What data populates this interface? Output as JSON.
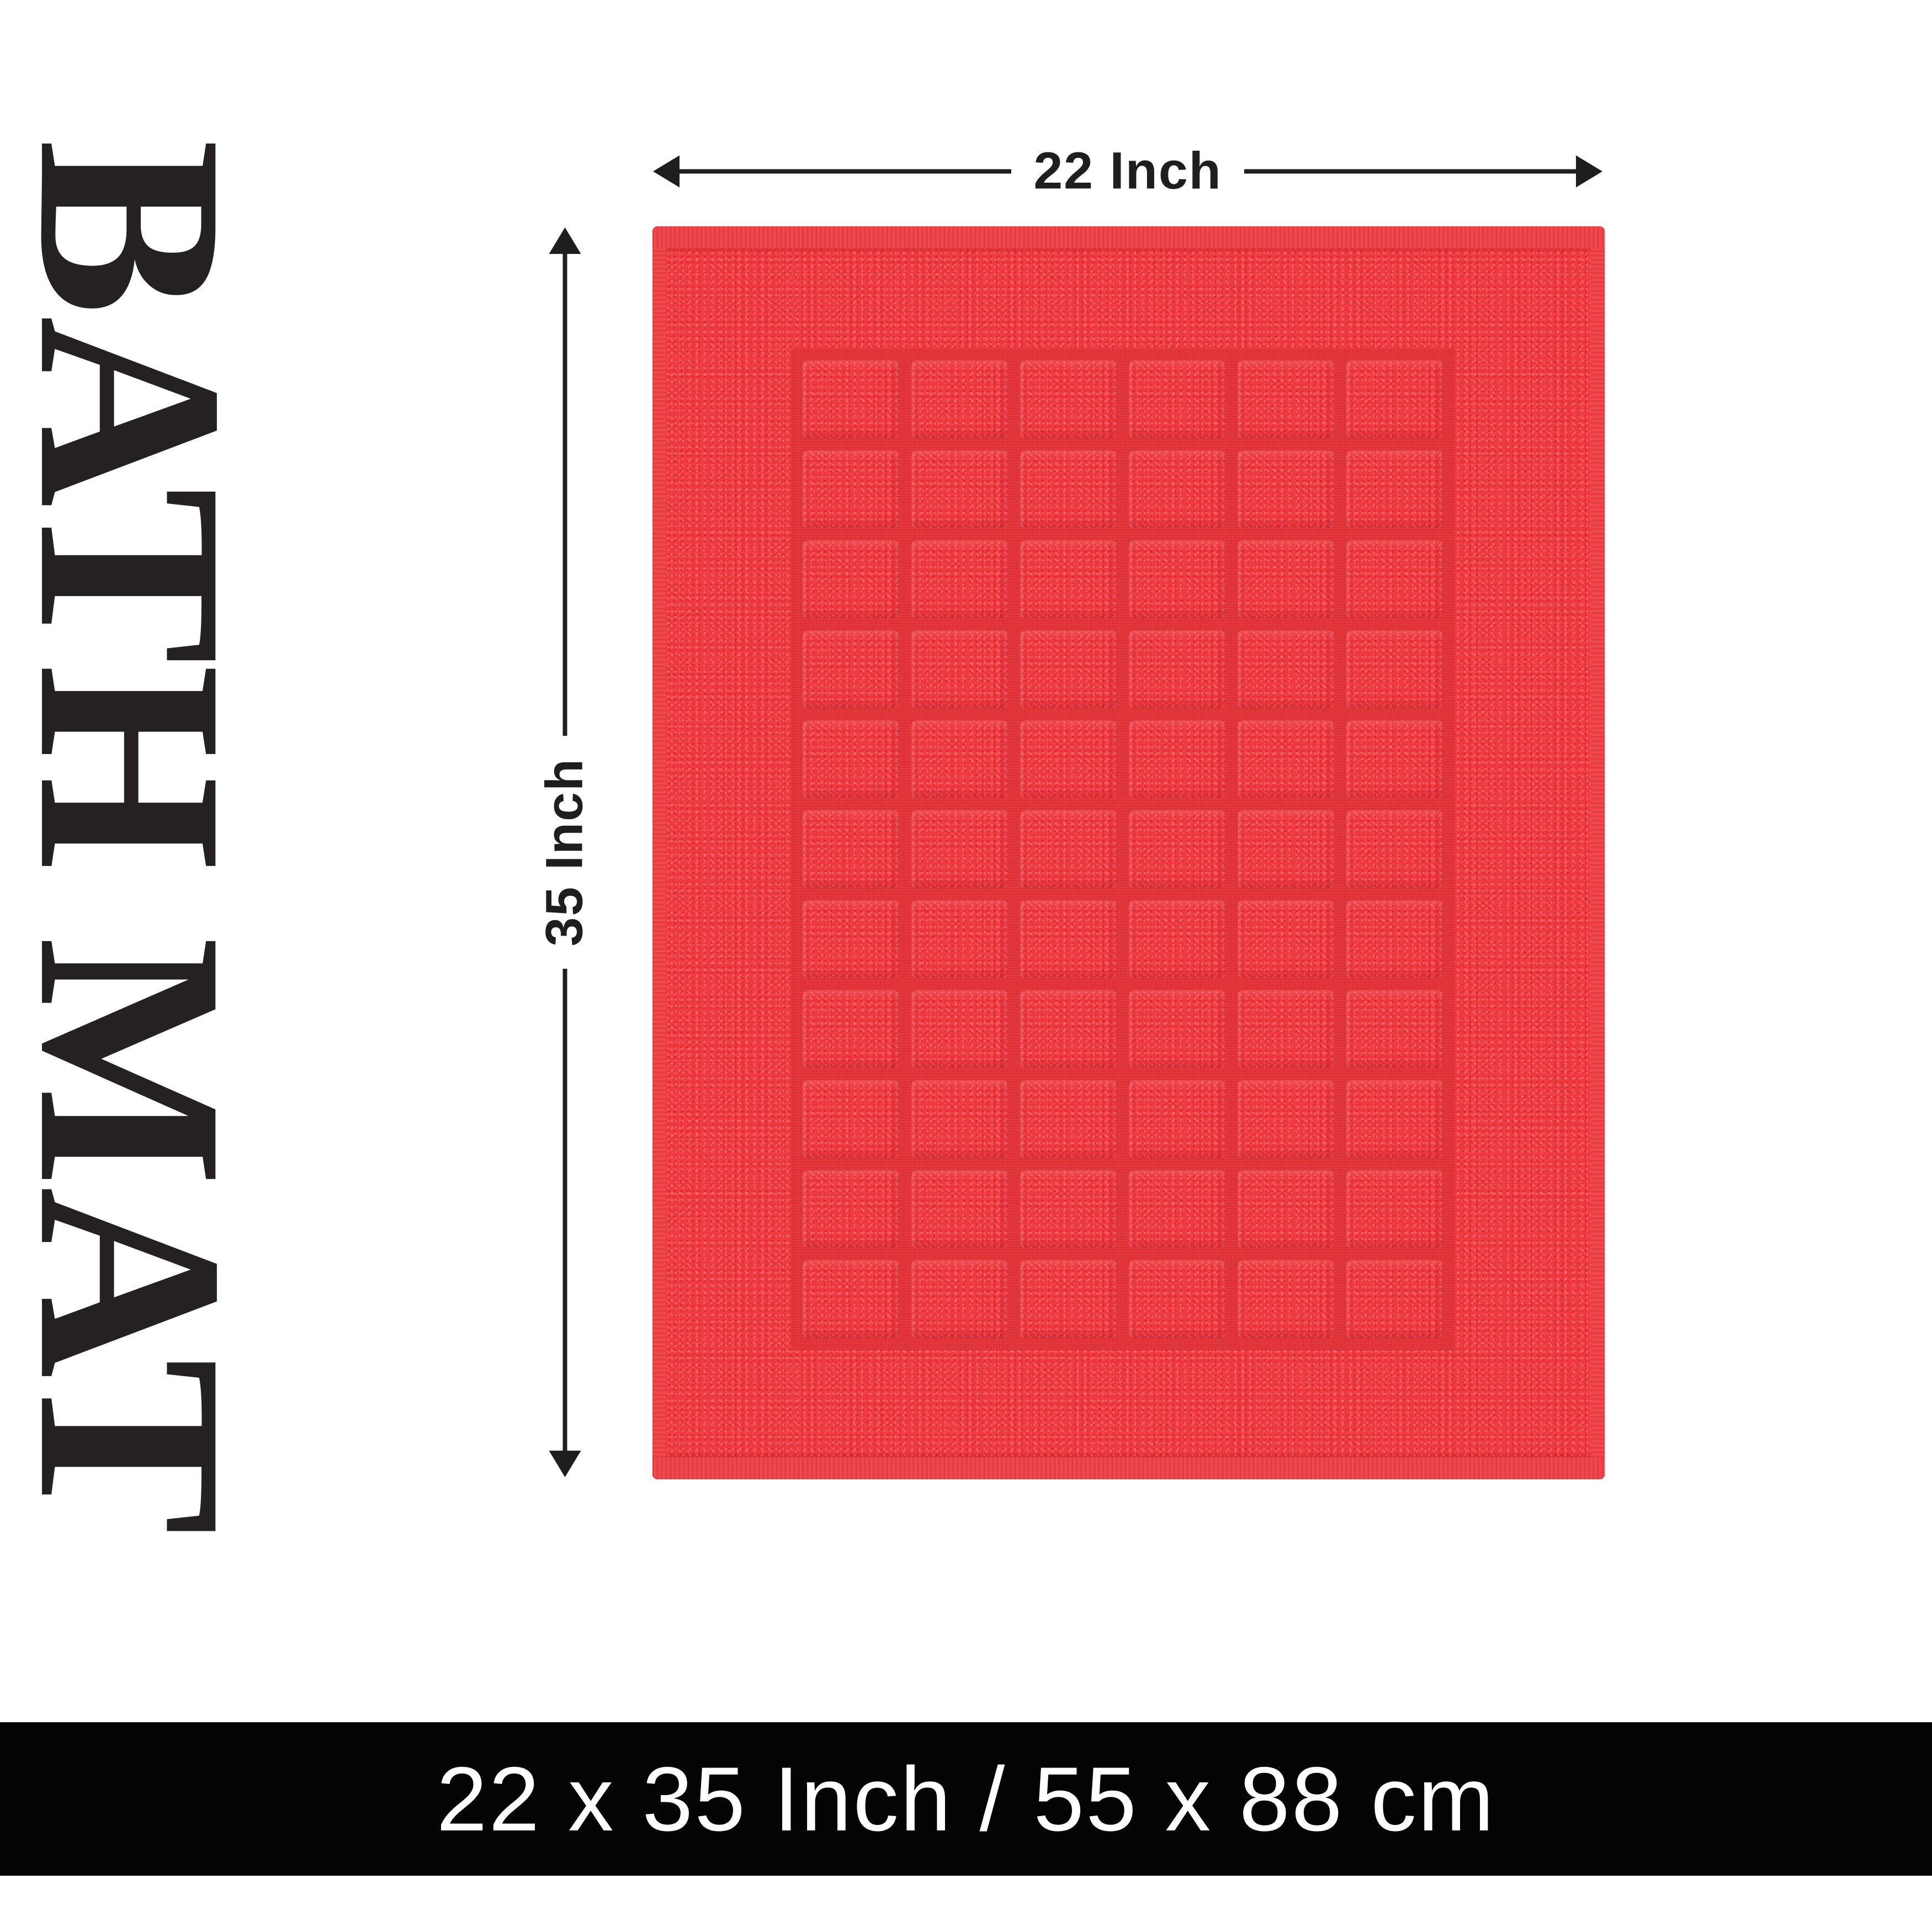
{
  "title": {
    "vertical_label": "BATH MAT"
  },
  "dimension_labels": {
    "width": "22 Inch",
    "height": "35 Inch"
  },
  "footer": {
    "size_text": "22 x 35 Inch / 55 x 88 cm"
  },
  "product": {
    "type": "checkered terry bath mat",
    "grid_columns": 6,
    "grid_rows": 11
  },
  "colors": {
    "background": "#ffffff",
    "pile_red": "#ee3a41",
    "channel_red": "#e23439",
    "hem_red": "#ef444a",
    "arrow_black": "#1f1d1e",
    "title_black": "#252123",
    "banner_black": "#040404",
    "banner_text": "#ffffff"
  }
}
